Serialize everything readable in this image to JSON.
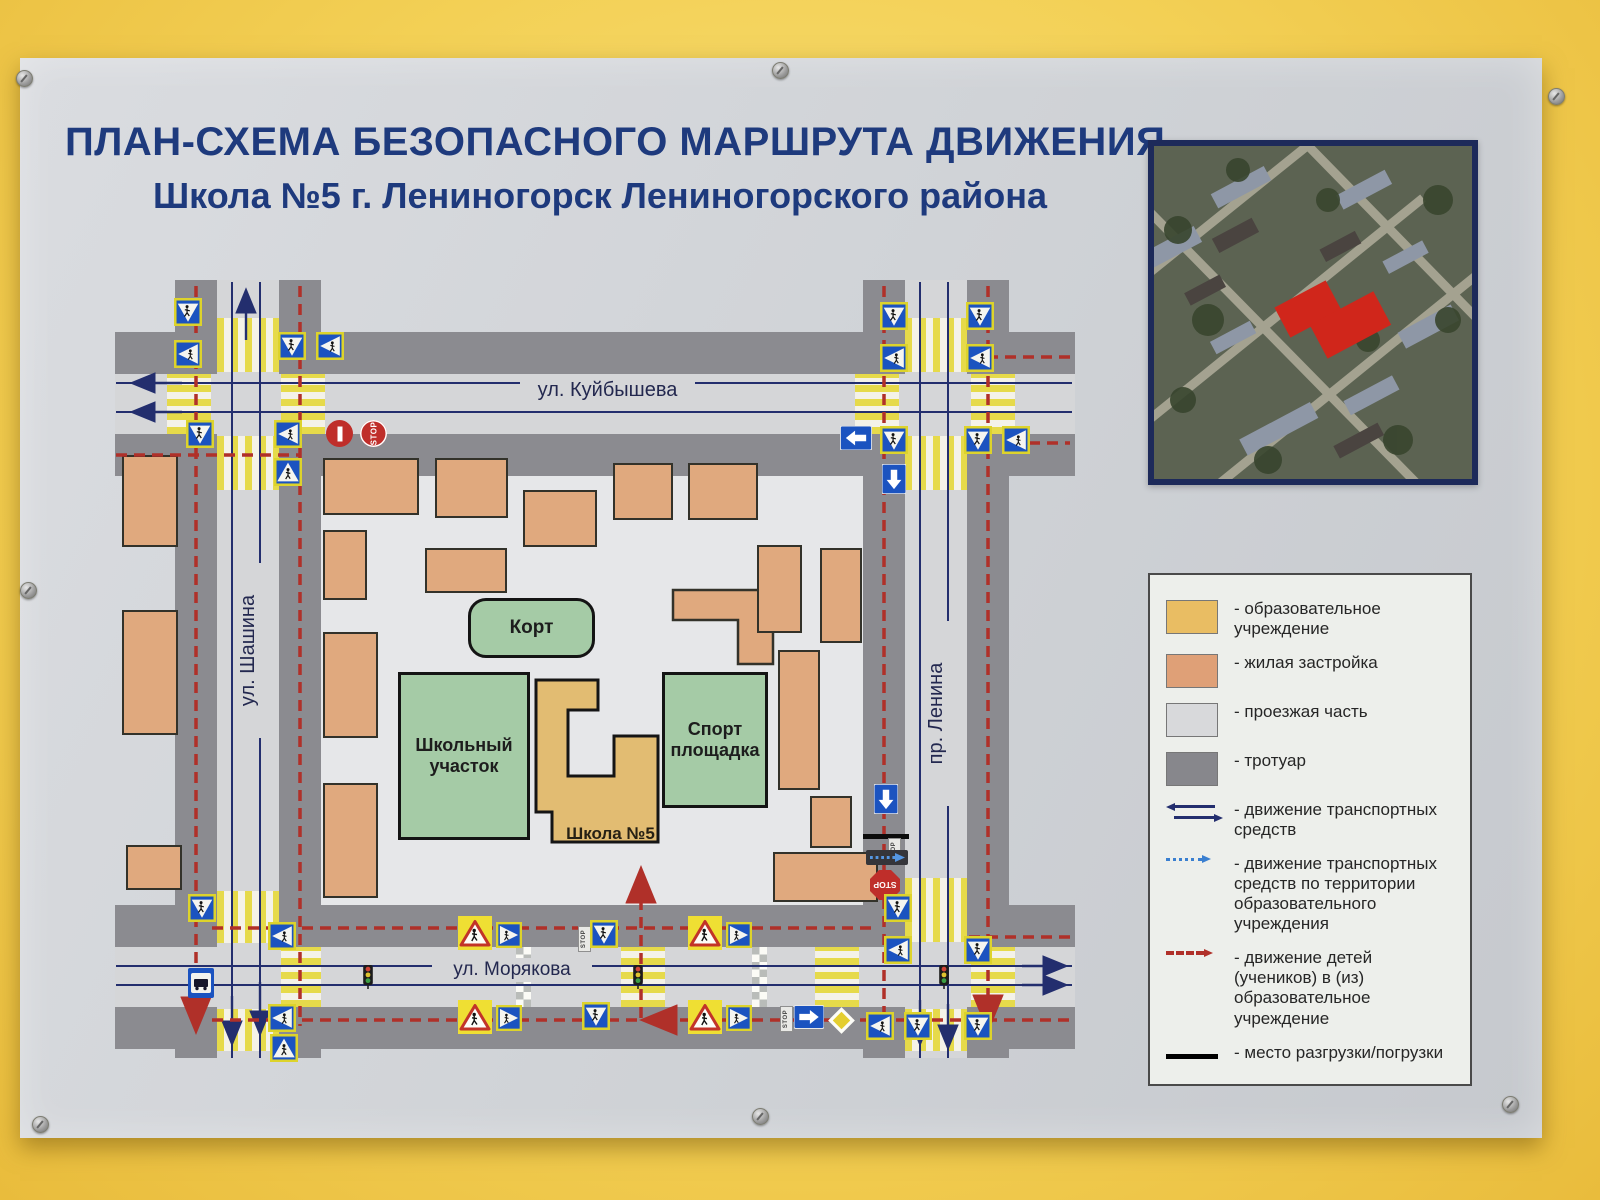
{
  "title": {
    "line1": "ПЛАН-СХЕМА БЕЗОПАСНОГО МАРШРУТА ДВИЖЕНИЯ",
    "line2": "Школа №5 г. Лениногорск Лениногорского района"
  },
  "map": {
    "streets": {
      "top": "ул. Куйбышева",
      "left": "ул. Шашина",
      "right": "пр. Ленина",
      "bottom": "ул. Морякова"
    },
    "areas": {
      "court": "Корт",
      "school_grounds": "Школьный участок",
      "sports_ground": "Спорт площадка",
      "school": "Школа №5"
    },
    "signs": {
      "stop": "STOP"
    }
  },
  "legend": {
    "items": [
      {
        "label": "- образовательное учреждение",
        "color": "#e9bd63"
      },
      {
        "label": "- жилая застройка",
        "color": "#dfa077"
      },
      {
        "label": "- проезжая часть",
        "color": "#d8d9db"
      },
      {
        "label": "- тротуар",
        "color": "#87878c"
      },
      {
        "label": "- движение транспортных средств",
        "color": "#232e6e"
      },
      {
        "label": "- движение транспортных средств по территории образовательного учреждения",
        "color": "#3a7fd0"
      },
      {
        "label": "- движение детей (учеников) в (из) образовательное учреждение",
        "color": "#b03029"
      },
      {
        "label": "- место разгрузки/погрузки",
        "color": "#000000"
      }
    ]
  }
}
